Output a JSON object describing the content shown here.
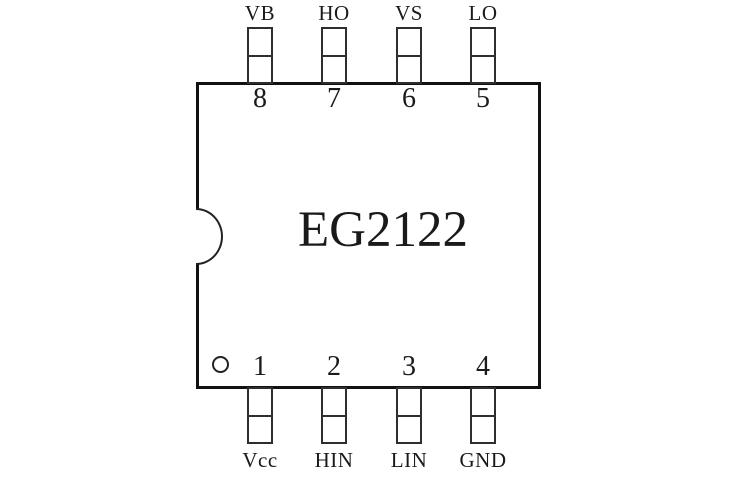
{
  "diagram": {
    "part_number": "EG2122"
  },
  "pins": {
    "top": [
      {
        "number": "8",
        "name": "VB"
      },
      {
        "number": "7",
        "name": "HO"
      },
      {
        "number": "6",
        "name": "VS"
      },
      {
        "number": "5",
        "name": "LO"
      }
    ],
    "bottom": [
      {
        "number": "1",
        "name": "Vcc"
      },
      {
        "number": "2",
        "name": "HIN"
      },
      {
        "number": "3",
        "name": "LIN"
      },
      {
        "number": "4",
        "name": "GND"
      }
    ]
  },
  "colors": {
    "line": "#111111",
    "background": "#ffffff",
    "text": "#1a1a1a"
  }
}
